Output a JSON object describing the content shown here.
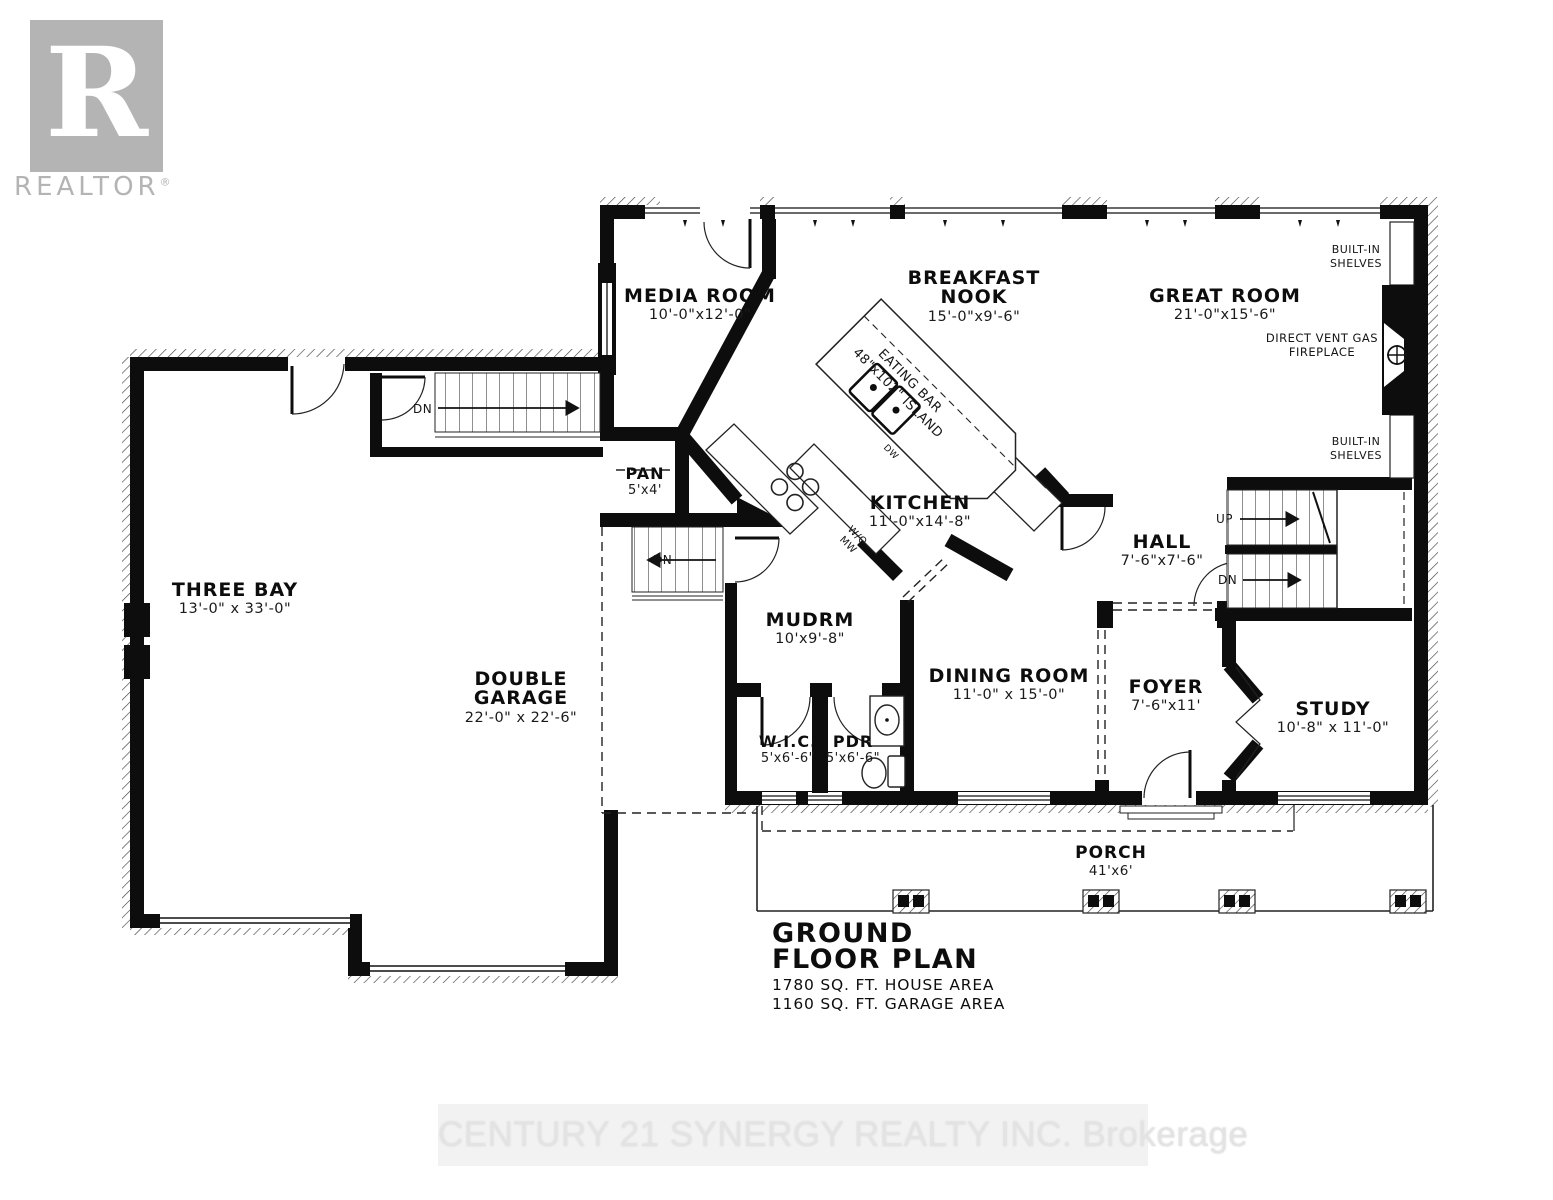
{
  "branding": {
    "logo_letter": "R",
    "logo_word": "REALTOR",
    "registered": "®",
    "watermark": "CENTURY 21 SYNERGY REALTY INC. Brokerage"
  },
  "title_block": {
    "line1": "GROUND",
    "line2": "FLOOR PLAN",
    "area1": "1780 SQ. FT. HOUSE AREA",
    "area2": "1160 SQ. FT. GARAGE AREA"
  },
  "rooms": {
    "media_room": {
      "name": "MEDIA ROOM",
      "dims": "10'-0\"x12'-0\""
    },
    "breakfast_nook": {
      "name": "BREAKFAST NOOK",
      "dims": "15'-0\"x9'-6\""
    },
    "great_room": {
      "name": "GREAT ROOM",
      "dims": "21'-0\"x15'-6\""
    },
    "kitchen": {
      "name": "KITCHEN",
      "dims": "11'-0\"x14'-8\""
    },
    "pan": {
      "name": "PAN",
      "dims": "5'x4'"
    },
    "hall": {
      "name": "HALL",
      "dims": "7'-6\"x7'-6\""
    },
    "mudrm": {
      "name": "MUDRM",
      "dims": "10'x9'-8\""
    },
    "three_bay": {
      "name": "THREE BAY",
      "dims": "13'-0\" x 33'-0\""
    },
    "double_garage": {
      "name": "DOUBLE GARAGE",
      "dims": "22'-0\" x 22'-6\""
    },
    "wic": {
      "name": "W.I.C.",
      "dims": "5'x6'-6\""
    },
    "pdr": {
      "name": "PDR",
      "dims": "5'x6'-6\""
    },
    "dining_room": {
      "name": "DINING ROOM",
      "dims": "11'-0\" x 15'-0\""
    },
    "foyer": {
      "name": "FOYER",
      "dims": "7'-6\"x11'"
    },
    "study": {
      "name": "STUDY",
      "dims": "10'-8\" x 11'-0\""
    },
    "porch": {
      "name": "PORCH",
      "dims": "41'x6'"
    }
  },
  "annotations": {
    "built_in_shelves": "BUILT-IN SHELVES",
    "fireplace": "DIRECT VENT GAS FIREPLACE",
    "eating_bar_line1": "EATING BAR",
    "eating_bar_line2": "48\"x102\" ISLAND",
    "wall_oven": "W/O MW",
    "dishwasher": "DW",
    "up": "UP",
    "down": "DN"
  },
  "colors": {
    "wall": "#0d0d0d",
    "hatch": "#444444",
    "logo_gray": "#b4b4b4",
    "watermark_text": "#e3e3e3",
    "watermark_band": "#f2f2f2"
  }
}
